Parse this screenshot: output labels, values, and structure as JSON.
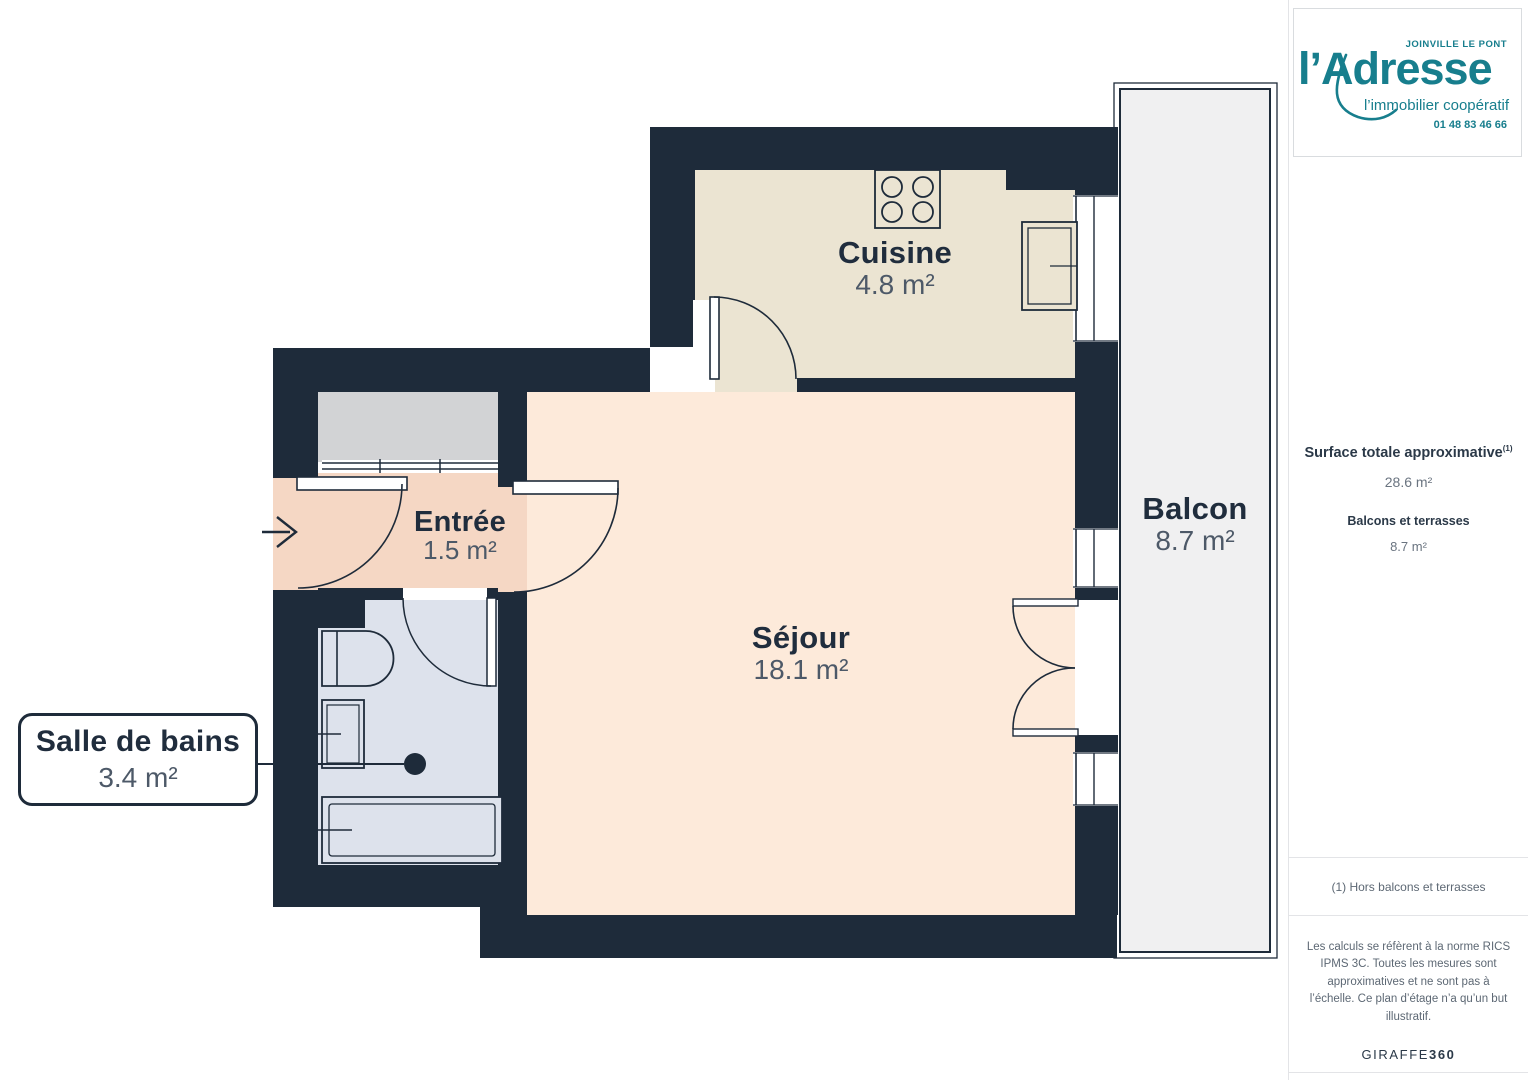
{
  "plan": {
    "rooms": {
      "cuisine": {
        "name": "Cuisine",
        "area": "4.8 m²"
      },
      "entree": {
        "name": "Entrée",
        "area": "1.5 m²"
      },
      "sejour": {
        "name": "Séjour",
        "area": "18.1 m²"
      },
      "salle_de_bains": {
        "name": "Salle de bains",
        "area": "3.4 m²"
      },
      "balcon": {
        "name": "Balcon",
        "area": "8.7 m²"
      }
    }
  },
  "sidebar": {
    "logo": {
      "city": "JOINVILLE LE PONT",
      "brand": "l’Adresse",
      "tagline": "l’immobilier coopératif",
      "phone": "01 48 83 46 66"
    },
    "surface_title": "Surface totale approximative",
    "surface_sup": "(1)",
    "surface_value": "28.6 m²",
    "balcons_title": "Balcons et terrasses",
    "balcons_value": "8.7 m²",
    "footnote": "(1) Hors balcons et terrasses",
    "disclaimer": "Les calculs se réfèrent à la norme RICS IPMS 3C. Toutes les mesures sont approximatives et ne sont pas à l’échelle. Ce plan d’étage n’a qu’un but illustratif.",
    "brand_footer_regular": "GIRAFFE",
    "brand_footer_bold": "360"
  },
  "colors": {
    "wall": "#1e2b3a",
    "cuisine_floor": "#ebe4d2",
    "sejour_floor": "#fdeada",
    "entree_floor": "#f5d7c4",
    "bain_floor": "#dde2ec",
    "closet": "#d2d3d5",
    "balcon_floor": "#f0f0f1",
    "accent_teal": "#177e8d",
    "label_navy": "#202d3d",
    "area_gray": "#4d5968",
    "muted_gray": "#5d6874"
  }
}
